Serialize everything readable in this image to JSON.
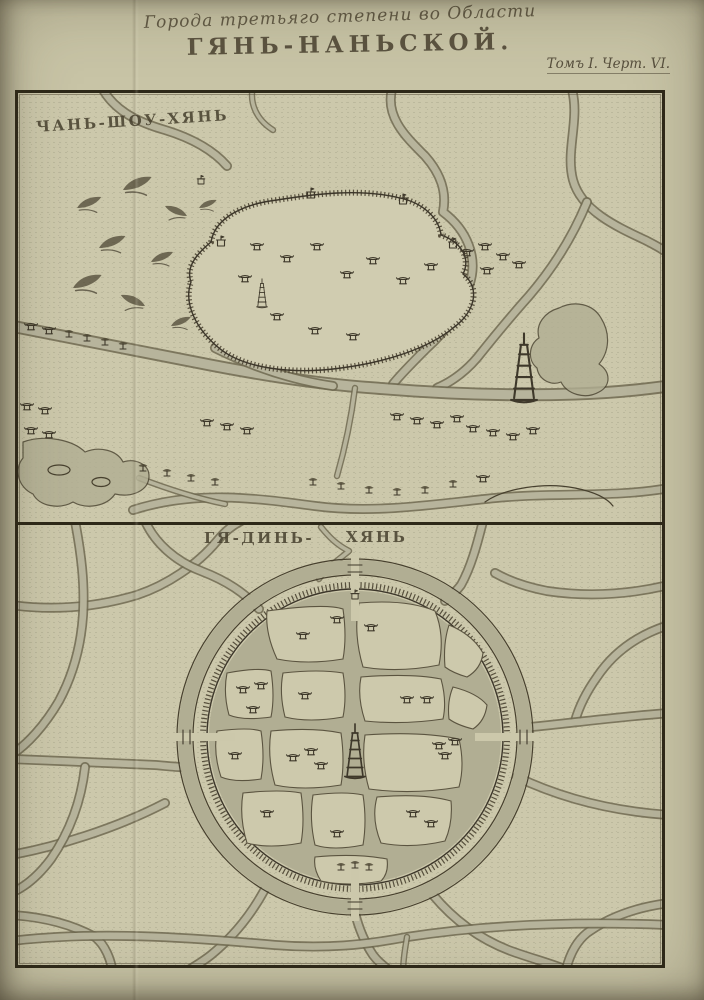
{
  "header": {
    "series_title": "Города третьяго степени во Области",
    "main_title": "ГЯНЬ-НАНЬСКОЙ.",
    "plate_label": "Томъ I. Черт. VI."
  },
  "maps": {
    "top": {
      "label": "ЧАНЬ-ШОУ-ХЯНЬ",
      "type": "engraved town plan with walled city, rivers, mountains"
    },
    "bottom": {
      "label": "ГЯ-ДИНЬ-ХЯНЬ",
      "label_parts": [
        "ГЯ-ДИНЬ-",
        "ХЯНЬ"
      ],
      "type": "engraved town plan with circular walled city and canals"
    }
  },
  "colors": {
    "paper": "#c8c4a6",
    "paper_inner": "#ccc8ab",
    "ink": "#3c362a",
    "wash": "#b1ae93",
    "frame": "#2d2818"
  }
}
